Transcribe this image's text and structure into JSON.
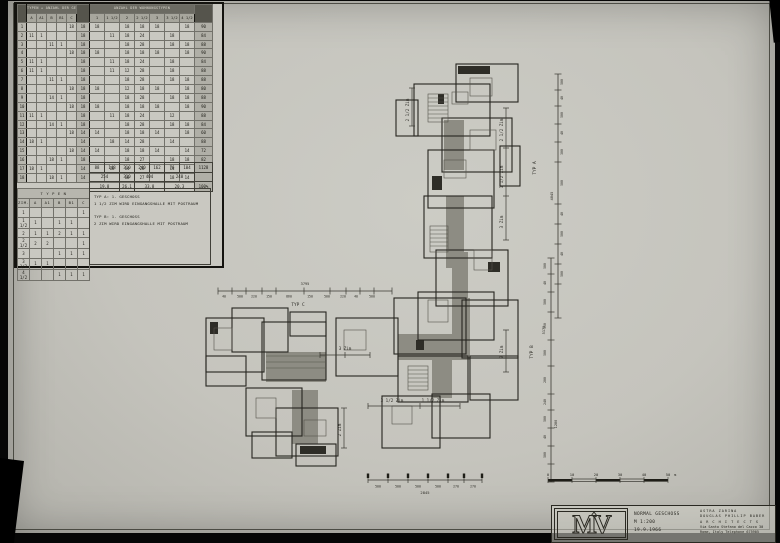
{
  "main_table": {
    "header_left": "TYPEN + ANZAHL DER GESCHOSSE",
    "header_right": "ANZAHL DER WOHNUNGSTYPEN",
    "col_left": [
      "A",
      "A1",
      "B",
      "B1",
      "C"
    ],
    "col_right": [
      "1",
      "1 1/2",
      "2",
      "2 1/2",
      "3",
      "3 1/2",
      "4 1/2"
    ],
    "rows": [
      [
        "1",
        "",
        "",
        "",
        "",
        "18",
        "18",
        "18",
        "",
        "18",
        "18",
        "18",
        "",
        "18",
        "90"
      ],
      [
        "2",
        "11",
        "1",
        "",
        "",
        "",
        "18",
        "",
        "11",
        "18",
        "24",
        "",
        "18",
        "",
        "84"
      ],
      [
        "3",
        "",
        "",
        "11",
        "1",
        "",
        "18",
        "",
        "",
        "18",
        "28",
        "",
        "18",
        "18",
        "88"
      ],
      [
        "4",
        "",
        "",
        "",
        "",
        "18",
        "18",
        "18",
        "",
        "18",
        "18",
        "18",
        "",
        "18",
        "90"
      ],
      [
        "5",
        "11",
        "1",
        "",
        "",
        "",
        "18",
        "",
        "11",
        "18",
        "24",
        "",
        "18",
        "",
        "84"
      ],
      [
        "6",
        "11",
        "1",
        "",
        "",
        "",
        "18",
        "",
        "11",
        "12",
        "28",
        "",
        "18",
        "",
        "88"
      ],
      [
        "7",
        "",
        "",
        "11",
        "1",
        "",
        "18",
        "",
        "",
        "18",
        "28",
        "",
        "18",
        "18",
        "88"
      ],
      [
        "8",
        "",
        "",
        "",
        "",
        "18",
        "18",
        "18",
        "",
        "12",
        "18",
        "18",
        "",
        "18",
        "80"
      ],
      [
        "9",
        "",
        "",
        "14",
        "1",
        "",
        "18",
        "",
        "",
        "18",
        "28",
        "",
        "18",
        "18",
        "88"
      ],
      [
        "10",
        "",
        "",
        "",
        "",
        "18",
        "18",
        "18",
        "",
        "18",
        "18",
        "18",
        "",
        "18",
        "90"
      ],
      [
        "11",
        "11",
        "1",
        "",
        "",
        "",
        "18",
        "",
        "11",
        "18",
        "24",
        "",
        "12",
        "",
        "88"
      ],
      [
        "12",
        "",
        "",
        "14",
        "1",
        "",
        "18",
        "",
        "",
        "18",
        "28",
        "",
        "18",
        "18",
        "84"
      ],
      [
        "13",
        "",
        "",
        "",
        "",
        "18",
        "14",
        "14",
        "",
        "18",
        "18",
        "14",
        "",
        "18",
        "60"
      ],
      [
        "14",
        "18",
        "1",
        "",
        "",
        "",
        "14",
        "",
        "18",
        "14",
        "28",
        "",
        "14",
        "",
        "88"
      ],
      [
        "15",
        "",
        "",
        "",
        "",
        "18",
        "14",
        "14",
        "",
        "18",
        "18",
        "14",
        "",
        "14",
        "72"
      ],
      [
        "16",
        "",
        "",
        "18",
        "1",
        "",
        "18",
        "",
        "",
        "18",
        "27",
        "",
        "18",
        "18",
        "82"
      ],
      [
        "17",
        "18",
        "1",
        "",
        "",
        "",
        "14",
        "",
        "18",
        "14",
        "28",
        "",
        "14",
        "",
        "88"
      ],
      [
        "18",
        "",
        "",
        "18",
        "1",
        "",
        "14",
        "",
        "",
        "18",
        "27",
        "",
        "18",
        "14",
        "98"
      ]
    ],
    "sum_row": [
      "88",
      "148",
      "310",
      "240",
      "162",
      "76",
      "104"
    ],
    "sum_total": "1128",
    "pair_row": [
      {
        "v": "254",
        "span": 2
      },
      {
        "v": "310",
        "span": 1
      },
      {
        "v": "404",
        "span": 2
      },
      {
        "v": "240",
        "span": 2
      }
    ],
    "pct_row": [
      {
        "v": "19.8",
        "span": 2
      },
      {
        "v": "26.1",
        "span": 1
      },
      {
        "v": "33.8",
        "span": 2
      },
      {
        "v": "20.3",
        "span": 2
      }
    ],
    "pct_total": "100%"
  },
  "typen_table": {
    "title": "T Y P E N",
    "col0": "ZIM.",
    "cols": [
      "A",
      "A1",
      "B",
      "B1",
      "C"
    ],
    "rows": [
      {
        "label": "1",
        "v": [
          "",
          "",
          "",
          "",
          "1"
        ]
      },
      {
        "label": "1 1/2",
        "v": [
          "1",
          "",
          "1",
          "1",
          ""
        ]
      },
      {
        "label": "2",
        "v": [
          "1",
          "1",
          "2",
          "1",
          "1"
        ]
      },
      {
        "label": "2 1/2",
        "v": [
          "2",
          "2",
          "",
          "",
          "1"
        ]
      },
      {
        "label": "3",
        "v": [
          "",
          "",
          "1",
          "1",
          "1"
        ]
      },
      {
        "label": "3 1/2",
        "v": [
          "1",
          "1",
          "",
          "",
          ""
        ]
      },
      {
        "label": "4 1/2",
        "v": [
          "",
          "",
          "1",
          "1",
          "1"
        ]
      }
    ]
  },
  "legend": {
    "a1": "TYP  A:   1. GESCHOSS",
    "a2": "1 1/2 ZIM WIRD EINGANGSHALLE MIT POSTRAUM",
    "b1": "TYP  B:   1. GESCHOSS",
    "b2": "2  ZIM WIRD EINGANGSHALLE MIT POSTRAUM"
  },
  "plan": {
    "labels": [
      {
        "t": "2 1/2 Zim",
        "x": 409,
        "y": 110,
        "r": -90
      },
      {
        "t": "2 1/2 Zim",
        "x": 503,
        "y": 130,
        "r": -90
      },
      {
        "t": "1 1/2 Zim",
        "x": 503,
        "y": 177,
        "r": -90
      },
      {
        "t": "3 Zim",
        "x": 503,
        "y": 222,
        "r": -90
      },
      {
        "t": "2 Zim",
        "x": 503,
        "y": 352,
        "r": -90
      },
      {
        "t": "2 Zim",
        "x": 341,
        "y": 430,
        "r": -90
      },
      {
        "t": "3 Zim",
        "x": 345,
        "y": 350,
        "r": 0
      },
      {
        "t": "3 1/2 Zim",
        "x": 392,
        "y": 402,
        "r": 0
      },
      {
        "t": "1 1/2 Zim",
        "x": 433,
        "y": 402,
        "r": 0
      }
    ]
  },
  "dims": {
    "top": {
      "label": "TYP C",
      "total": "3795",
      "segments": [
        "40",
        "500",
        "220",
        "150",
        "860",
        "150",
        "500",
        "220",
        "40",
        "500"
      ]
    },
    "right_a": {
      "label": "TYP A",
      "total": "4845",
      "segments": [
        "500",
        "40",
        "500",
        "40",
        "300",
        "500",
        "40",
        "500",
        "40",
        "500"
      ]
    },
    "right_b": {
      "label": "TYP B",
      "total_1": "5175",
      "total_2": "1280",
      "segments": [
        "500",
        "40",
        "500",
        "350",
        "500",
        "200",
        "240",
        "500",
        "40",
        "500"
      ]
    },
    "bottom": {
      "total": "2845",
      "segments": [
        "500",
        "500",
        "500",
        "500",
        "270",
        "270"
      ]
    }
  },
  "scalebar": {
    "ticks": [
      "0",
      "10",
      "20",
      "30",
      "40",
      "50"
    ],
    "unit": "m"
  },
  "titleblock": {
    "logo": "MV",
    "title": "NORMAL GESCHOSS",
    "scale": "M 1:200",
    "date": "19.9.1966",
    "firm_line1": "ASTRA ZARINA",
    "firm_line2": "DOUGLAS PHILLIP BABER",
    "firm_line3": "A R C H I T E C T S",
    "firm_line4": "Via Santo Stefano del Cacco 30",
    "firm_line5": "Rome, Italy     Telephone 675905"
  }
}
